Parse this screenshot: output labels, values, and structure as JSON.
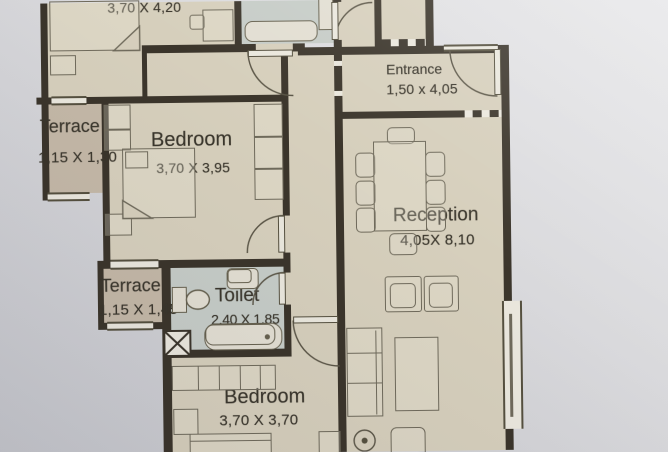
{
  "rooms": {
    "bedroom_top": {
      "dims": "3,70 X 4,20"
    },
    "terrace_1": {
      "name": "Terrace",
      "dims": "1,15 X 1,30"
    },
    "bedroom_mid": {
      "name": "Bedroom",
      "dims": "3,70 X 3,95"
    },
    "entrance": {
      "name": "Entrance",
      "dims": "1,50 x 4,05"
    },
    "reception": {
      "name": "Reception",
      "dims": "4,05X 8,10"
    },
    "terrace_2": {
      "name": "Terrace",
      "dims": "1,15 X 1,45"
    },
    "toilet": {
      "name": "Toilet",
      "dims": "2,40 X 1,85"
    },
    "bedroom_bottom": {
      "name": "Bedroom",
      "dims": "3,70 X 3,70"
    }
  },
  "colors": {
    "wall": "#3b352b",
    "floor": "#d6cfbc",
    "wet_room": "#c6ccc7",
    "terrace": "#c4b8a7",
    "paper": "#d8d8db",
    "linework": "#6f6a5b"
  }
}
